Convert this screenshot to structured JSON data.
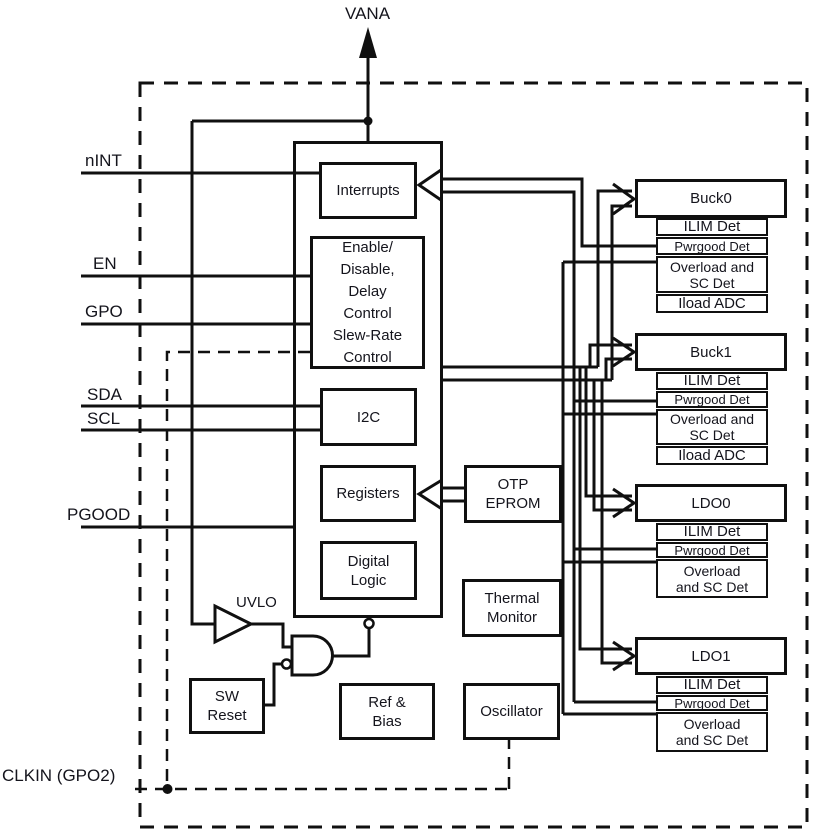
{
  "power_rail": {
    "label": "VANA"
  },
  "pins": {
    "nint": "nINT",
    "en": "EN",
    "gpo": "GPO",
    "sda": "SDA",
    "scl": "SCL",
    "pgood": "PGOOD",
    "clkin": "CLKIN (GPO2)"
  },
  "core": {
    "interrupts": "Interrupts",
    "enable_lines": [
      "Enable/",
      "Disable,",
      "Delay",
      "Control",
      "Slew-Rate",
      "Control"
    ],
    "i2c": "I2C",
    "registers": "Registers",
    "digital_logic_lines": [
      "Digital",
      "Logic"
    ]
  },
  "support": {
    "otp_lines": [
      "OTP",
      "EPROM"
    ],
    "thermal_lines": [
      "Thermal",
      "Monitor"
    ],
    "oscillator": "Oscillator",
    "ref_bias_lines": [
      "Ref &",
      "Bias"
    ],
    "sw_reset_lines": [
      "SW",
      "Reset"
    ],
    "uvlo": "UVLO"
  },
  "outputs": [
    {
      "name": "Buck0",
      "subs": [
        {
          "lines": [
            "ILIM Det"
          ]
        },
        {
          "lines": [
            "Pwrgood Det"
          ]
        },
        {
          "lines": [
            "Overload and",
            "SC Det"
          ]
        },
        {
          "lines": [
            "Iload ADC"
          ]
        }
      ]
    },
    {
      "name": "Buck1",
      "subs": [
        {
          "lines": [
            "ILIM Det"
          ]
        },
        {
          "lines": [
            "Pwrgood Det"
          ]
        },
        {
          "lines": [
            "Overload and",
            "SC Det"
          ]
        },
        {
          "lines": [
            "Iload ADC"
          ]
        }
      ]
    },
    {
      "name": "LDO0",
      "subs": [
        {
          "lines": [
            "ILIM Det"
          ]
        },
        {
          "lines": [
            "Pwrgood Det"
          ]
        },
        {
          "lines": [
            "Overload",
            "and SC Det"
          ]
        }
      ]
    },
    {
      "name": "LDO1",
      "subs": [
        {
          "lines": [
            "ILIM Det"
          ]
        },
        {
          "lines": [
            "Pwrgood Det"
          ]
        },
        {
          "lines": [
            "Overload",
            "and SC Det"
          ]
        }
      ]
    }
  ],
  "colors": {
    "line": "#101010",
    "text": "#14141c"
  }
}
